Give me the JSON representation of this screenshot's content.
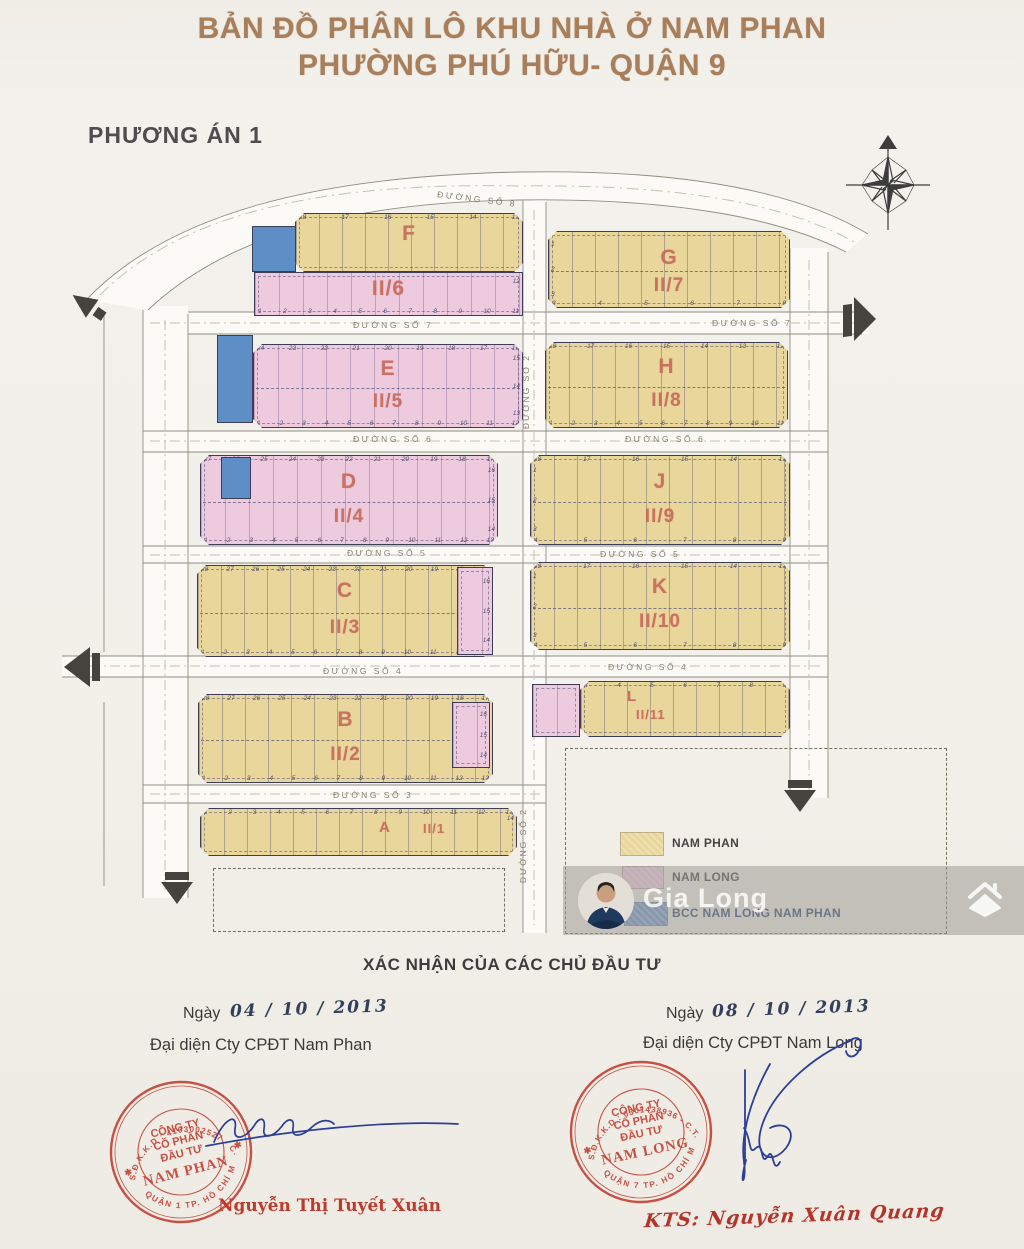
{
  "title": {
    "line1": "BẢN ĐỒ PHÂN LÔ KHU NHÀ Ở NAM PHAN",
    "line2": "PHƯỜNG PHÚ HỮU- QUẬN 9"
  },
  "plan_label": "PHƯƠNG ÁN 1",
  "colors": {
    "nam_phan_yellow": "#e9d69b",
    "nam_long_pink": "#eecade",
    "bcc_blue": "#5d8ec6",
    "block_label_salmon": "#c76c5c",
    "stamp_red": "#c23b2e",
    "signature_blue": "#2b3f96",
    "title_brown": "#a87e5b"
  },
  "road_labels": {
    "s8": "ĐƯỜNG SỐ 8",
    "s7a": "ĐƯỜNG SỐ 7",
    "s7b": "ĐƯỜNG SỐ 7",
    "s6a": "ĐƯỜNG SỐ 6",
    "s6b": "ĐƯỜNG SỐ 6",
    "s5a": "ĐƯỜNG SỐ 5",
    "s5b": "ĐƯỜNG SỐ 5",
    "s4a": "ĐƯỜNG SỐ 4",
    "s4b": "ĐƯỜNG SỐ 4",
    "s3": "ĐƯỜNG SỐ 3",
    "s2a": "ĐƯỜNG SỐ 2",
    "s2b": "ĐƯỜNG SỐ 2"
  },
  "blocks": {
    "F": {
      "label": "F",
      "sub": "II/6",
      "lots_top": [
        "18",
        "17",
        "16",
        "15",
        "14",
        "13"
      ],
      "lots_bottom": [
        "1",
        "2",
        "3",
        "4",
        "5",
        "6",
        "7",
        "8",
        "9",
        "10",
        "11"
      ],
      "lots_right": [
        "12"
      ]
    },
    "G": {
      "label": "G",
      "sub": "II/7",
      "lots_left": [
        "1",
        "2",
        "3"
      ],
      "lots_bottom": [
        "3",
        "4",
        "5",
        "6",
        "7",
        "8"
      ]
    },
    "E": {
      "label": "E",
      "sub": "II/5",
      "lots_top": [
        "24",
        "23",
        "22",
        "21",
        "20",
        "19",
        "18",
        "17",
        "16"
      ],
      "lots_bottom": [
        "1",
        "2",
        "3",
        "4",
        "5",
        "6",
        "7",
        "8",
        "9",
        "10",
        "11",
        "12"
      ],
      "lots_right": [
        "15",
        "14",
        "13"
      ]
    },
    "H": {
      "label": "H",
      "sub": "II/8",
      "lots_top": [
        "18",
        "17",
        "16",
        "15",
        "14",
        "13",
        "12"
      ],
      "lots_bottom": [
        "1",
        "2",
        "3",
        "4",
        "5",
        "6",
        "7",
        "8",
        "9",
        "10",
        "11"
      ]
    },
    "D": {
      "label": "D",
      "sub": "II/4",
      "lots_top": [
        "27",
        "26",
        "25",
        "24",
        "23",
        "22",
        "21",
        "20",
        "19",
        "18",
        "17"
      ],
      "lots_bottom": [
        "1",
        "2",
        "3",
        "4",
        "5",
        "6",
        "7",
        "8",
        "9",
        "10",
        "11",
        "12",
        "13"
      ],
      "lots_right": [
        "16",
        "15",
        "14"
      ]
    },
    "J": {
      "label": "J",
      "sub": "II/9",
      "lots_left": [
        "1",
        "2",
        "3"
      ],
      "lots_top": [
        "18",
        "17",
        "16",
        "15",
        "14",
        "13"
      ],
      "lots_bottom": [
        "4",
        "5",
        "6",
        "7",
        "8",
        "9"
      ]
    },
    "C": {
      "label": "C",
      "sub": "II/3",
      "lots_top": [
        "28",
        "27",
        "26",
        "25",
        "24",
        "23",
        "22",
        "21",
        "20",
        "19",
        "18",
        "17"
      ],
      "lots_bottom": [
        "1",
        "2",
        "3",
        "4",
        "5",
        "6",
        "7",
        "8",
        "9",
        "10",
        "11",
        "12",
        "13"
      ],
      "lots_right": [
        "16",
        "15",
        "14"
      ]
    },
    "K": {
      "label": "K",
      "sub": "II/10",
      "lots_left": [
        "1",
        "2",
        "3"
      ],
      "lots_top": [
        "18",
        "17",
        "16",
        "15",
        "14",
        "13"
      ],
      "lots_bottom": [
        "4",
        "5",
        "6",
        "7",
        "8",
        "9"
      ]
    },
    "B": {
      "label": "B",
      "sub": "II/2",
      "lots_top": [
        "28",
        "27",
        "26",
        "25",
        "24",
        "23",
        "22",
        "21",
        "20",
        "19",
        "18",
        "17"
      ],
      "lots_bottom": [
        "1",
        "2",
        "3",
        "4",
        "5",
        "6",
        "7",
        "8",
        "9",
        "10",
        "11",
        "12",
        "13"
      ],
      "lots_right": [
        "16",
        "15",
        "14"
      ]
    },
    "L": {
      "label": "L",
      "sub": "II/11",
      "lots_top": [
        "3",
        "4",
        "5",
        "6",
        "7",
        "8",
        "9"
      ]
    },
    "A": {
      "label": "A",
      "sub": "II/1",
      "lots_top": [
        "1",
        "2",
        "3",
        "4",
        "5",
        "6",
        "7",
        "8",
        "9",
        "10",
        "11",
        "12",
        "13"
      ],
      "lots_right": [
        "14"
      ]
    }
  },
  "legend": {
    "items": [
      {
        "label": "NAM PHAN",
        "color": "#e9d69b"
      },
      {
        "label": "NAM LONG",
        "color": "#eecade"
      },
      {
        "label": "BCC NAM LONG NAM PHAN",
        "color": "#6d94c8"
      }
    ]
  },
  "watermark": {
    "name": "Gia Long"
  },
  "confirmation": {
    "heading": "XÁC NHẬN CỦA CÁC CHỦ ĐẦU TƯ",
    "left": {
      "date_label": "Ngày",
      "date_hand": "04 / 10 / 2013",
      "rep": "Đại diện Cty CPĐT Nam Phan",
      "signer": "Nguyễn Thị Tuyết Xuân",
      "stamp": {
        "ring_top": "S.Đ.K.K.D : 4103002527 - C.T.C",
        "ring_bottom": "QUẬN 1 TP. HỒ CHÍ MINH",
        "org1": "CÔNG TY",
        "org2": "CỔ PHẦN",
        "org3": "ĐẦU TƯ",
        "name": "NAM PHAN"
      }
    },
    "right": {
      "date_label": "Ngày",
      "date_hand": "08 / 10 / 2013",
      "rep": "Đại diện Cty CPĐT Nam Long",
      "signer": "KTS: Nguyễn Xuân Quang",
      "stamp": {
        "ring_top": "S.Đ.K.K.D : 0301438936 - C.T.C.P",
        "ring_bottom": "QUẬN 7 TP. HỒ CHÍ MINH",
        "org1": "CÔNG TY",
        "org2": "CỔ PHẦN",
        "org3": "ĐẦU TƯ",
        "name": "NAM LONG"
      }
    }
  }
}
